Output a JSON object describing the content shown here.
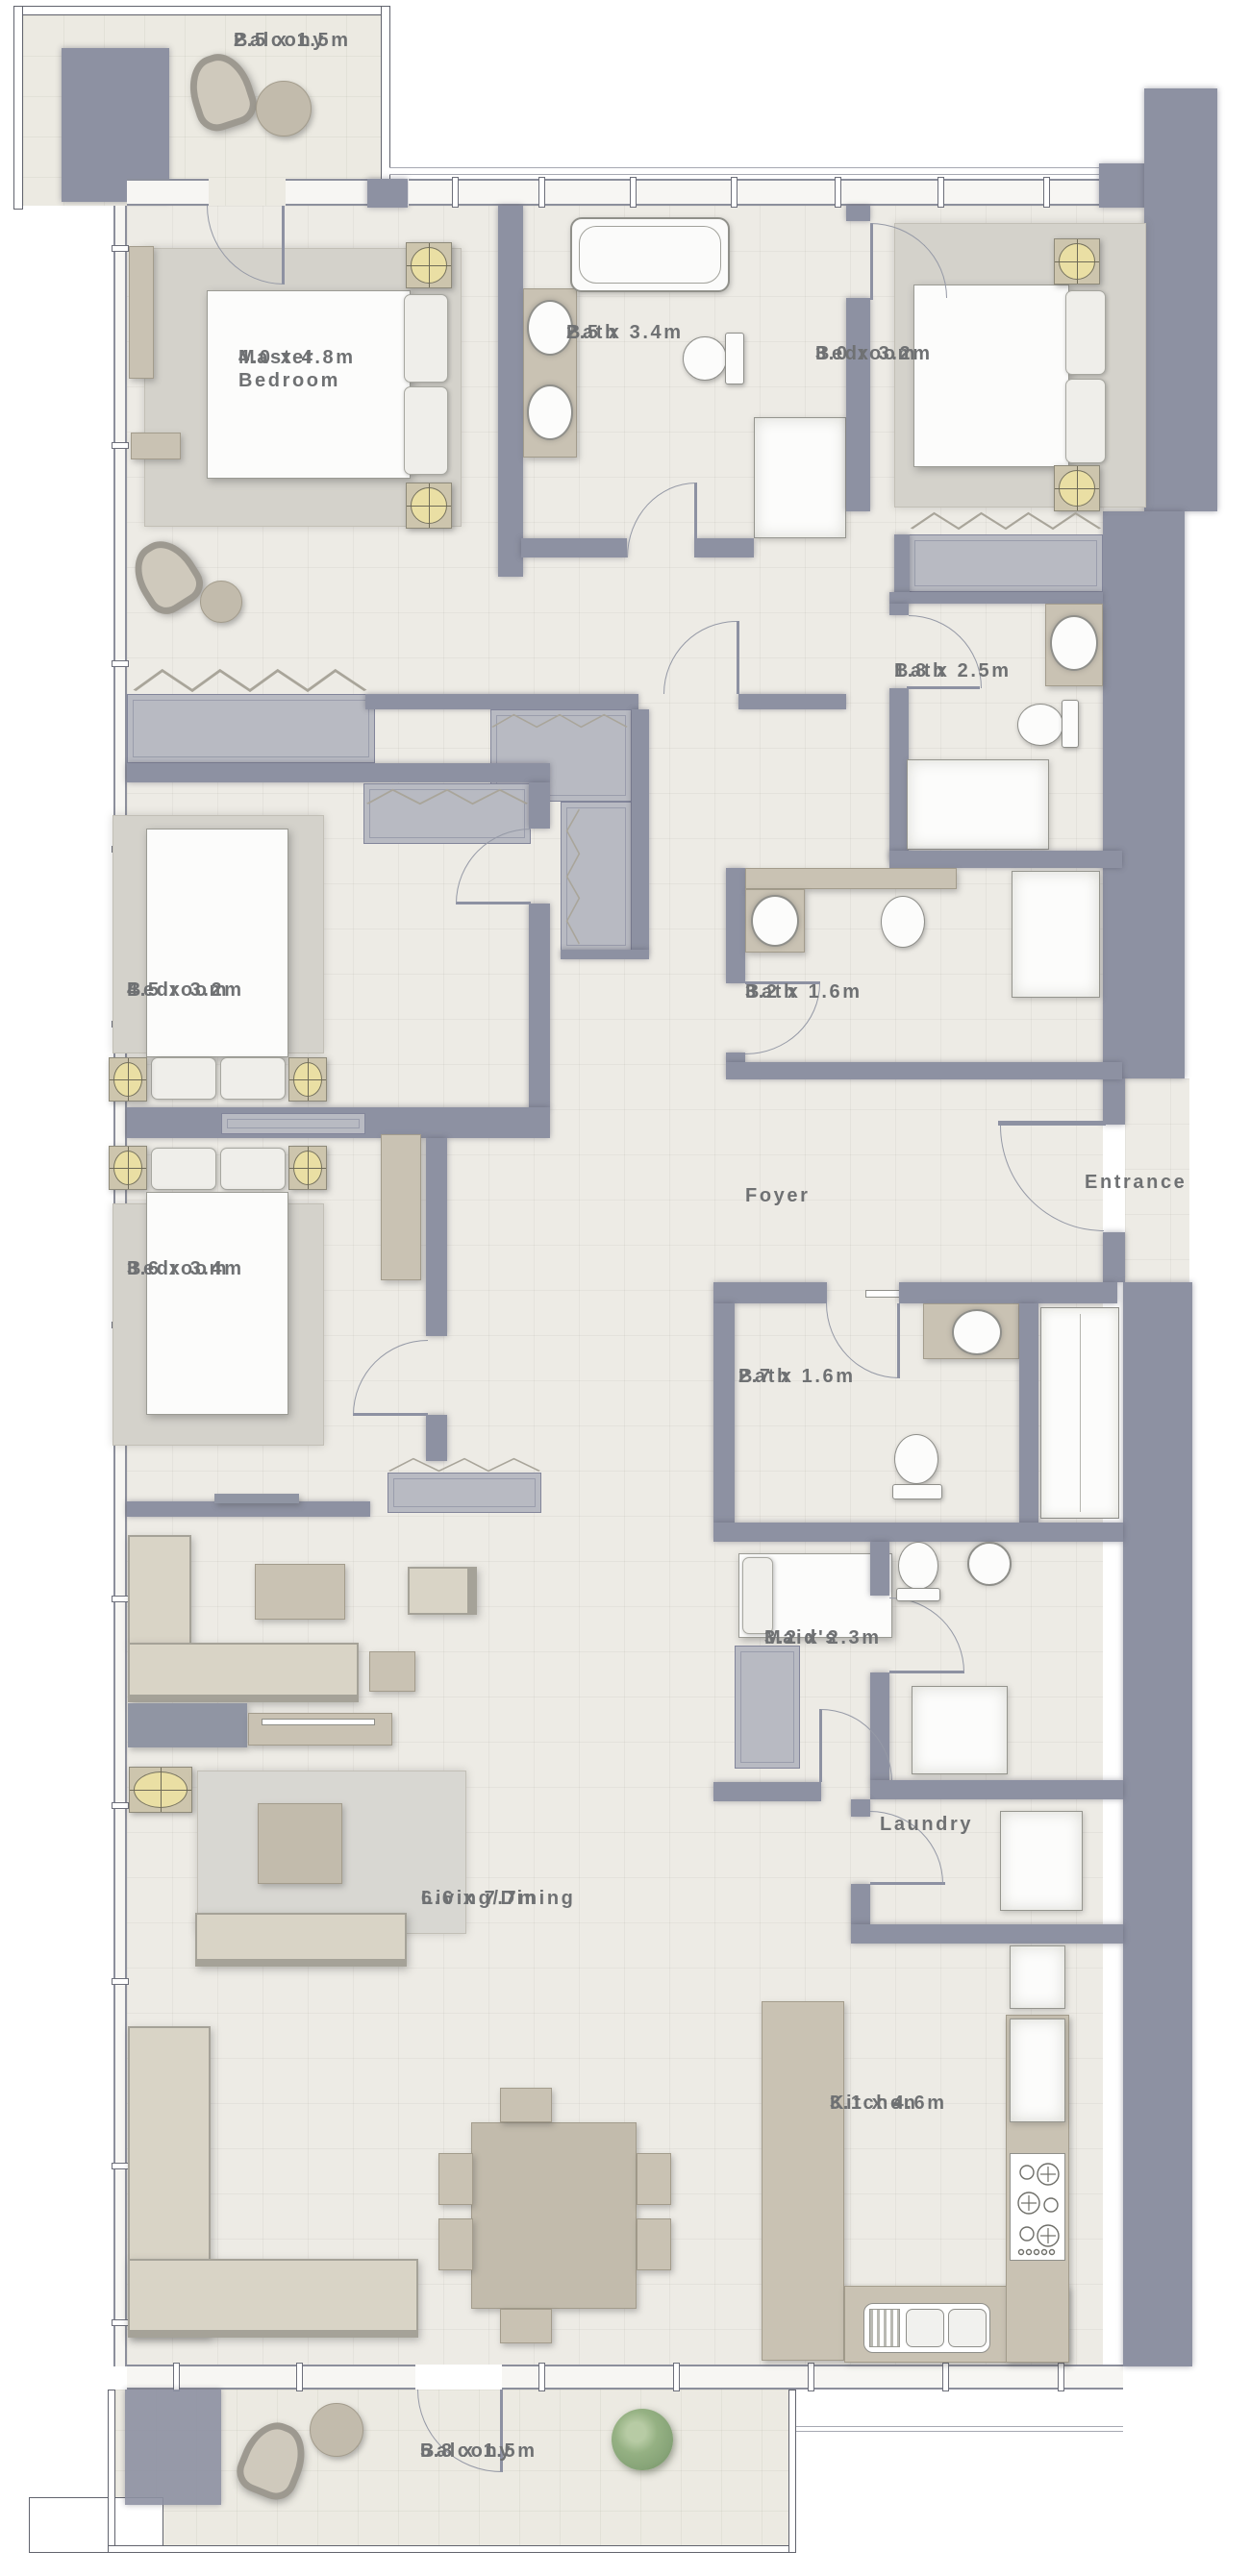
{
  "colors": {
    "wall": "#8d91a2",
    "floor": "#edebe5",
    "floorb": "#eceae2",
    "rug": "#d5d3cc",
    "tan": "#c9c2b3",
    "sofa": "#d9d4c6",
    "gfur": "#9095a3",
    "cab": "#b8bac2",
    "lamp": "#eadfa4",
    "plant": "#87a478",
    "text": "#6f7173"
  },
  "rooms": {
    "balcony_top": {
      "name": "Balcony",
      "dims": "2.5 x 1.5m"
    },
    "master_bedroom": {
      "name": "Master Bedroom",
      "dims": "4.0 x 4.8m"
    },
    "master_bath": {
      "name": "Bath",
      "dims": "2.5 x 3.4m"
    },
    "bedroom_2": {
      "name": "Bedroom",
      "dims": "3.0 x 3.2m"
    },
    "bath_2": {
      "name": "Bath",
      "dims": "1.8 x 2.5m"
    },
    "bath_3": {
      "name": "Bath",
      "dims": "3.2 x 1.6m"
    },
    "foyer": {
      "name": "Foyer"
    },
    "entrance": {
      "name": "Entrance"
    },
    "bedroom_3": {
      "name": "Bedroom",
      "dims": "4.5 x 3.2m"
    },
    "bedroom_4": {
      "name": "Bedroom",
      "dims": "3.6 x 3.4m"
    },
    "bath_4": {
      "name": "Bath",
      "dims": "2.7 x 1.6m"
    },
    "maids": {
      "name": "Maid's",
      "dims": "3.2 x 2.3m"
    },
    "laundry": {
      "name": "Laundry"
    },
    "living_dining": {
      "name": "Living/Dining",
      "dims": "6.6 x 7.7m"
    },
    "kitchen": {
      "name": "Kitchen",
      "dims": "3.1 x 4.6m"
    },
    "balcony_bottom": {
      "name": "Balcony",
      "dims": "5.8 x 1.5m"
    }
  }
}
